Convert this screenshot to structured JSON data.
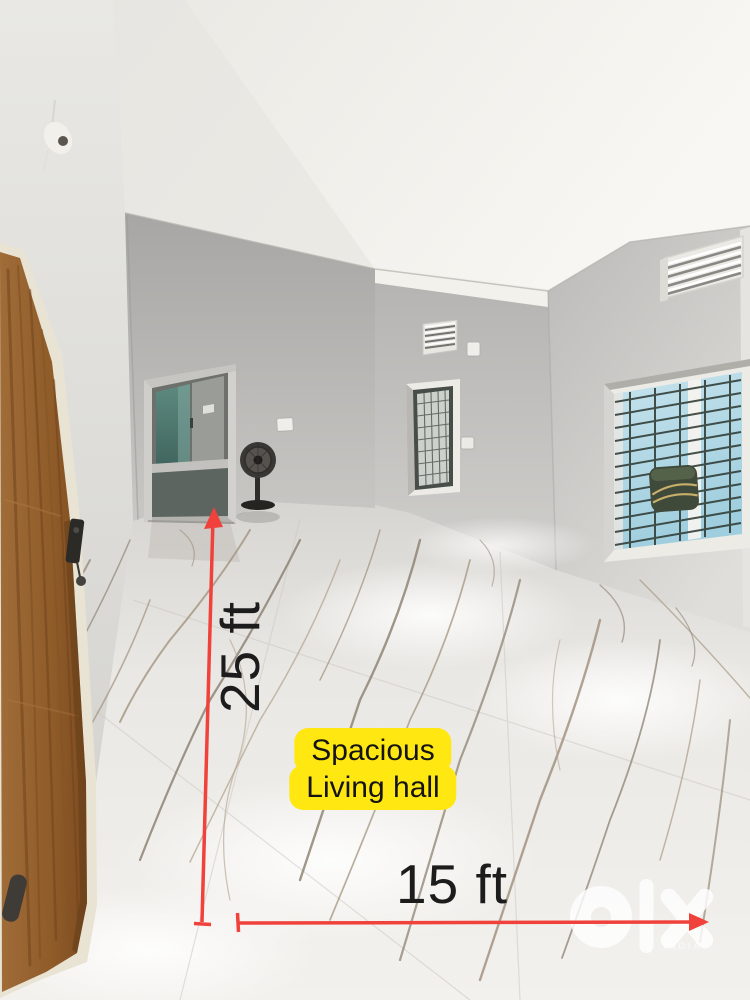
{
  "annotations": {
    "vertical_measurement": "25 ft",
    "horizontal_measurement": "15 ft",
    "room_label": {
      "line1": "Spacious",
      "line2": "Living hall"
    }
  },
  "watermark": {
    "brand": "olx",
    "country": "INDIA"
  },
  "colors": {
    "measure_line": "#f0413b",
    "measure_text": "#1c1c1c",
    "label_bg": "#ffe712",
    "label_text": "#141414",
    "watermark": "#ffffff",
    "wall_gray": "#c2c1bf",
    "ceiling_white": "#f6f4f0",
    "door_brown": "#96642f",
    "window_sky": "#b3d9e6"
  }
}
